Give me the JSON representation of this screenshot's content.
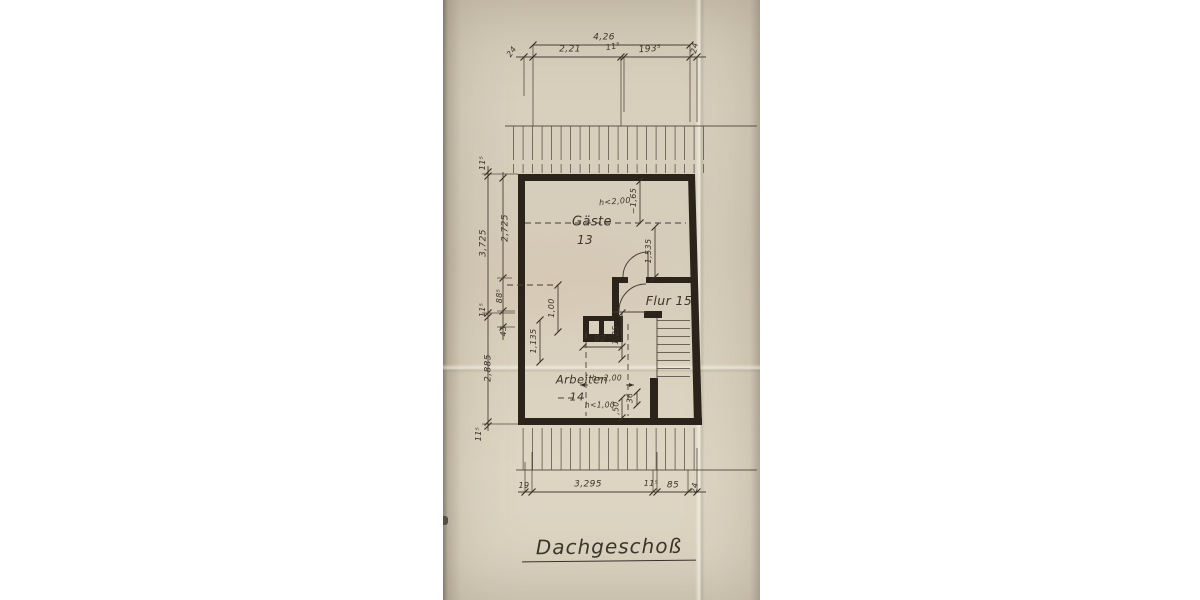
{
  "title": {
    "text": "Dachgeschoß"
  },
  "rooms": {
    "gaeste": {
      "name": "Gäste",
      "number": "13"
    },
    "flur": {
      "label": "Flur 15"
    },
    "arbeiten": {
      "name": "Arbeiten",
      "number": "14"
    }
  },
  "dims": {
    "top": {
      "overall": "4,26",
      "left_wall": "24",
      "seg1": "2,21",
      "seg2": "11⁵",
      "seg3": "193⁵",
      "right_wall": "24"
    },
    "left": {
      "outer": [
        "11⁵",
        "3,725",
        "11⁵",
        "2,885",
        "11⁵"
      ],
      "inner": [
        "2,725",
        "88⁵",
        "43"
      ]
    },
    "bottom": [
      "19",
      "3,295",
      "11⁵",
      "85",
      "24"
    ],
    "interior": {
      "gaeste_height": "h<2,00",
      "dim_165": "~1,65",
      "dim_1535": "1,535",
      "dim_100": "1,00",
      "dim_1135": "1,135",
      "dim_92": "92",
      "dim_125": "1,25",
      "height_200": "h=2,00",
      "height_100": "h<1,00",
      "dim_50": ",50",
      "dim_36": "36"
    }
  }
}
